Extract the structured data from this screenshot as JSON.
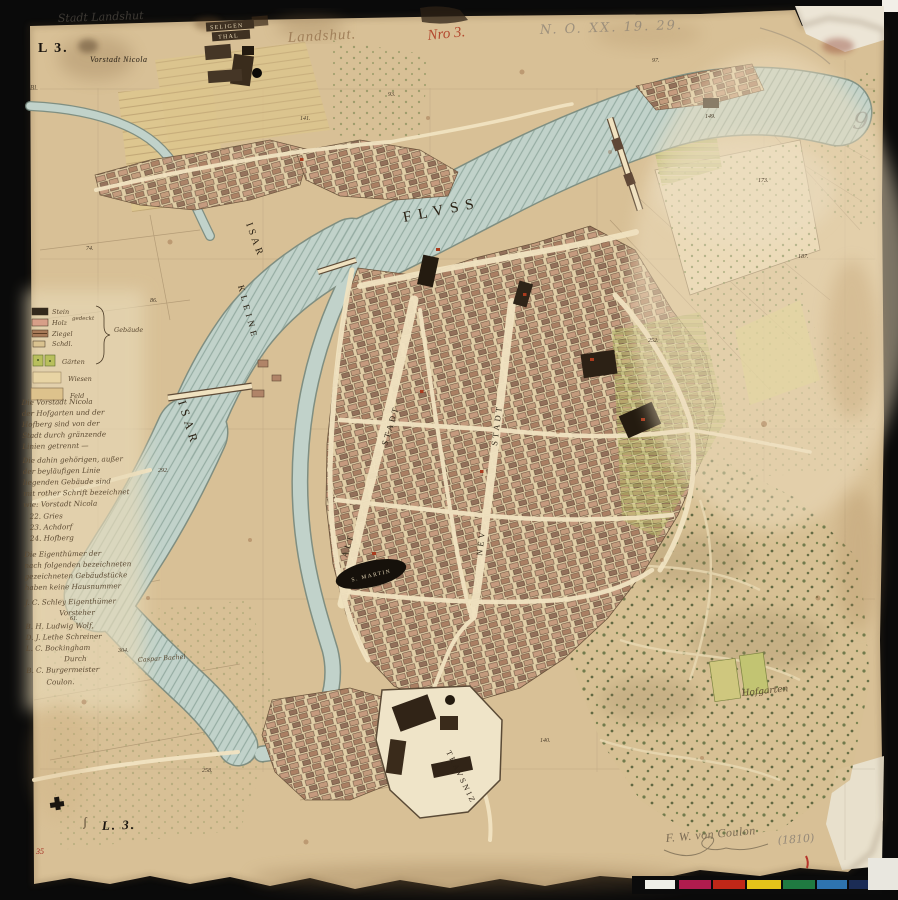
{
  "artifact": {
    "sheet_front": "L 3.",
    "sheet_back": "L. 3.",
    "red_inventory": "35",
    "title_ink": "Landshut.",
    "red_number": "Nro 3.",
    "pencil_topleft": "Stadt Landshut",
    "pencil_topright": "N. O. XX. 19. 29.",
    "pencil_flourish": "9",
    "margin_mark": "Bl.",
    "comma_mark": "ʃ",
    "signature": "F. W. von Coulon",
    "year": "(1810)"
  },
  "labels": {
    "suburb": "Vorstadt Nicola",
    "convent_line1": "SELIGEN",
    "convent_line2": "THAL",
    "fluss": "FLVSS",
    "isar_upper": "ISAR",
    "kleine": "KLEINE",
    "isar_lower": "ISAR",
    "alt": "ALT",
    "alt_stadt": "STADT",
    "neu": "NEV",
    "neu_stadt": "STADT",
    "st_martin": "S. MARTIN",
    "trausnitz": "TRAVSNIZ",
    "hofgarten": "Hofgarten",
    "meadow_owner": "Caspar Bachel"
  },
  "legend": {
    "materials": [
      {
        "label": "Stein",
        "color": "#33291c"
      },
      {
        "label": "Holz",
        "color": "#d79f88"
      },
      {
        "label": "Ziegel",
        "color": "#a87a58"
      },
      {
        "label": "Schdl.",
        "color": "#d9c290"
      }
    ],
    "gedeckt": "gedeckt",
    "group": "Gebäude",
    "land": [
      {
        "label": "Gärten",
        "color": "#b8bf5c"
      },
      {
        "label": "Wiesen",
        "color": "#e8d4a4"
      },
      {
        "label": "Feld",
        "color": "#ddc28c"
      }
    ]
  },
  "note_lines": [
    "Die Vorstadt Nicola",
    "der Hofgarten und der",
    "Hofberg sind von der",
    "Stadt durch gränzende",
    "Linien getrennt —",
    "Die dahin gehörigen, außer",
    "der beyläufigen Linie",
    "liegenden Gebäude sind",
    "mit rother Schrift bezeichnet",
    "wie: Vorstadt Nicola",
    "22. Gries",
    "23. Achdorf",
    "24. Hofberg",
    "Die Eigenthümer der",
    "nach folgenden bezeichneten",
    "gezeichneten Gebäudstücke",
    "haben keine Hausnummer",
    "J. C. Schley Eigenthümer",
    "Vorsteher",
    "B. H. Ludwig Wolf,",
    "D. J. Lethe Schreiner",
    "L. C. Bockingham",
    "Durch",
    "B. C. Burgermeister",
    "Coulon."
  ],
  "parcels": [
    "141.",
    "74.",
    "93.",
    "97.",
    "149.",
    "173.",
    "187.",
    "252.",
    "292.",
    "304.",
    "86.",
    "258.",
    "140.",
    "61."
  ],
  "colorbar": {
    "chips": [
      "#efefe8",
      "#b01c4e",
      "#bf2718",
      "#e4c41a",
      "#1f7a41",
      "#2e74af",
      "#1b2c55"
    ]
  }
}
